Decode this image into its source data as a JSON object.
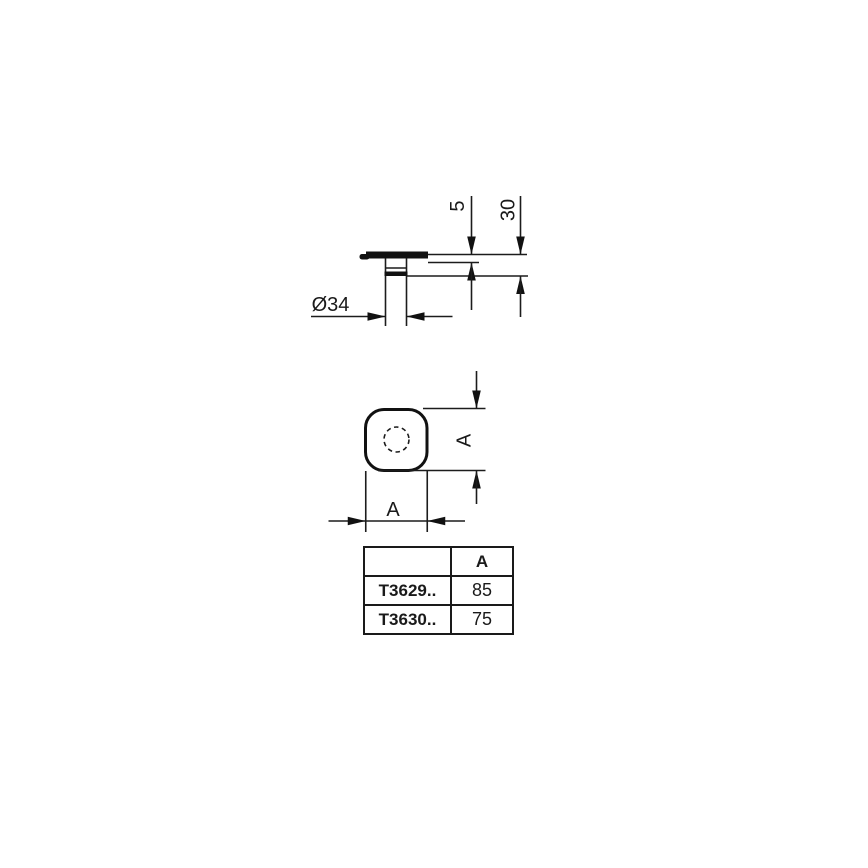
{
  "drawing": {
    "side_view": {
      "dim_lip_height": "5",
      "dim_depth": "30",
      "dim_diameter": "Ø34"
    },
    "plan_view": {
      "dim_height": "A",
      "dim_width": "A"
    }
  },
  "table": {
    "col_header": "A",
    "rows": [
      {
        "model": "T3629..",
        "value": "85"
      },
      {
        "model": "T3630..",
        "value": "75"
      }
    ]
  },
  "colors": {
    "line": "#1c1c1c",
    "text": "#1a1a1a",
    "background": "#ffffff"
  }
}
